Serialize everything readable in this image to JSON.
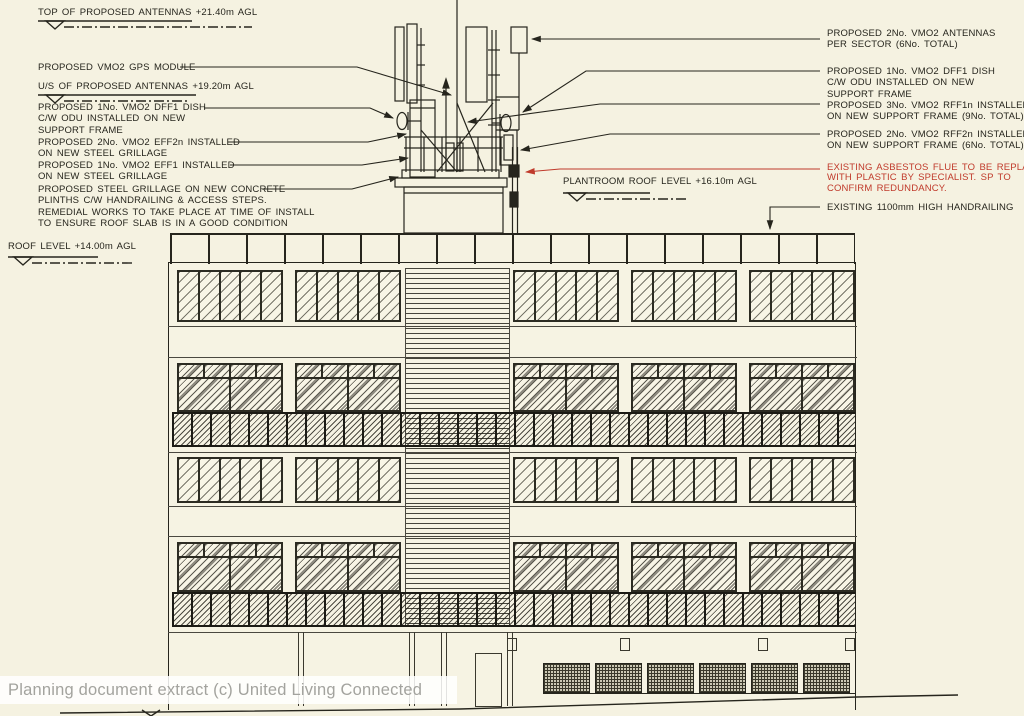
{
  "colors": {
    "background": "#f5f2e1",
    "ink": "#26251d",
    "red_note": "#c03a2b",
    "watermark_text": "#a3a39e"
  },
  "levels": {
    "top_antennas": "TOP OF PROPOSED ANTENNAS +21.40m AGL",
    "us_antennas": "U/S OF PROPOSED ANTENNAS +19.20m AGL",
    "plantroom_roof": "PLANTROOM ROOF LEVEL +16.10m AGL",
    "roof": "ROOF LEVEL +14.00m AGL"
  },
  "callouts_left": {
    "gps": [
      "PROPOSED VMO2 GPS MODULE"
    ],
    "dff1": [
      "PROPOSED 1No. VMO2 DFF1 DISH",
      "C/W ODU INSTALLED ON NEW",
      "SUPPORT FRAME"
    ],
    "eff2n": [
      "PROPOSED 2No. VMO2 EFF2n INSTALLED",
      "ON NEW STEEL GRILLAGE"
    ],
    "eff1": [
      "PROPOSED 1No. VMO2 EFF1 INSTALLED",
      "ON NEW STEEL GRILLAGE"
    ],
    "grillage": [
      "PROPOSED STEEL GRILLAGE ON NEW CONCRETE",
      "PLINTHS C/W HANDRAILING & ACCESS STEPS.",
      "REMEDIAL WORKS TO TAKE PLACE AT TIME OF INSTALL",
      "TO ENSURE ROOF SLAB IS IN A GOOD CONDITION"
    ]
  },
  "callouts_right": {
    "antennas": [
      "PROPOSED 2No. VMO2 ANTENNAS",
      "PER SECTOR (6No. TOTAL)"
    ],
    "dff1": [
      "PROPOSED 1No. VMO2 DFF1 DISH",
      "C/W ODU INSTALLED ON NEW",
      "SUPPORT FRAME"
    ],
    "rff1n": [
      "PROPOSED 3No. VMO2 RFF1n INSTALLED",
      "ON NEW SUPPORT FRAME (9No. TOTAL)"
    ],
    "rff2n": [
      "PROPOSED 2No. VMO2 RFF2n INSTALLED",
      "ON NEW SUPPORT FRAME (6No. TOTAL)"
    ],
    "asbestos": [
      "EXISTING ASBESTOS FLUE TO BE REPLACED",
      "WITH PLASTIC BY SPECIALIST. SP TO",
      "CONFIRM REDUNDANCY."
    ],
    "handrailing": [
      "EXISTING 1100mm HIGH HANDRAILING"
    ]
  },
  "watermark": "Planning document extract (c) United Living Connected"
}
